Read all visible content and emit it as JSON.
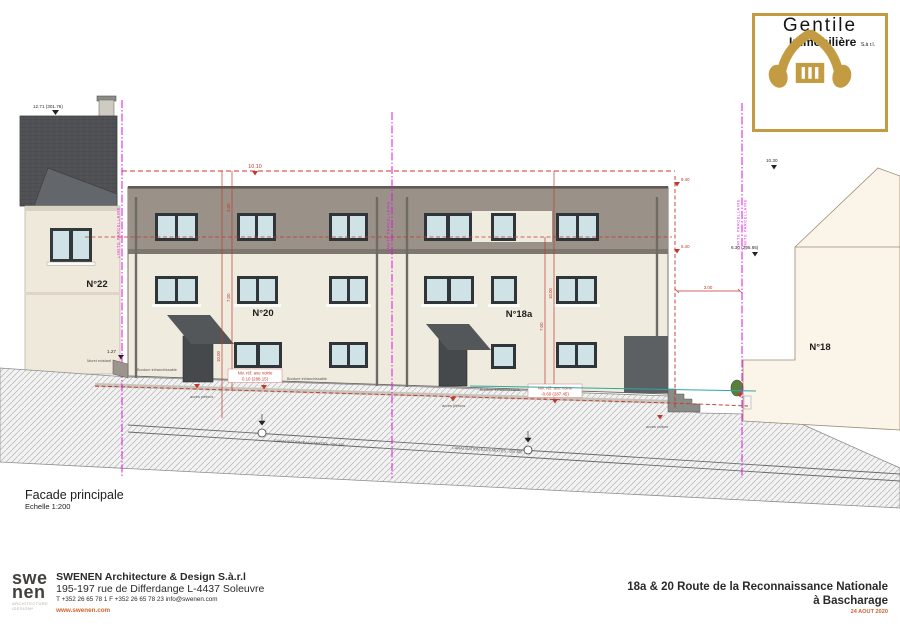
{
  "logo": {
    "name": "Gentile",
    "subname": "Immobilière",
    "suffix": "S.à r.l.",
    "icon": "hands-roof-house-icon",
    "accent": "#c39b43"
  },
  "drawing": {
    "title": "Facade principale",
    "scale": "Echelle 1:200",
    "buildings": {
      "n22": "N°22",
      "n20": "N°20",
      "n18a": "N°18a",
      "n18": "N°18"
    },
    "ann": {
      "n22_ridge": "12.71 (301.76)",
      "gabarit": "10.10",
      "level_top": "9.40",
      "level_attic": "6.40",
      "n18_max": "10.30",
      "n18_eave": "6.30 (295.65)",
      "dim_300": "3.00",
      "dim_700": "7.00",
      "dim_1000": "10.00",
      "level_127": "1.27",
      "niv_line1": "Niv. réf. axe voirie",
      "niv20": "0.10 (288.15)",
      "niv18a": "-0.60 (287.45)",
      "limite": "LIMITE PARCELLAIRE",
      "bordure": "Bordure infranchissable",
      "muret": "Muret existant",
      "acces_pietons": "accès piétons",
      "acces_voiture": "accès voiture",
      "canalisation": "CANALISATION EAUX MIXTES - DN 300"
    },
    "colors": {
      "magenta": "#e012e0",
      "dim_red": "#c0392b",
      "teal": "#2ca8a2",
      "wall": "#f0ebdf",
      "attic_band": "#9a9288",
      "orange": "#d4622a"
    }
  },
  "footer": {
    "firm_logo_top": "swe",
    "firm_logo_bottom": "nen",
    "firm_logo_sub1": "ARCHITECTURE",
    "firm_logo_sub2": "/DESIGN",
    "firm_name": "SWENEN Architecture & Design S.à.r.l",
    "firm_address": "195-197 rue de Differdange L-4437 Soleuvre",
    "firm_contact": "T +352 26 65 78 1 F +352 26 65 78 23  info@swenen.com",
    "firm_website": "www.swenen.com",
    "project_line1": "18a & 20 Route de la Reconnaissance Nationale",
    "project_line2": "à Bascharage",
    "project_date": "24 AOUT 2020"
  }
}
